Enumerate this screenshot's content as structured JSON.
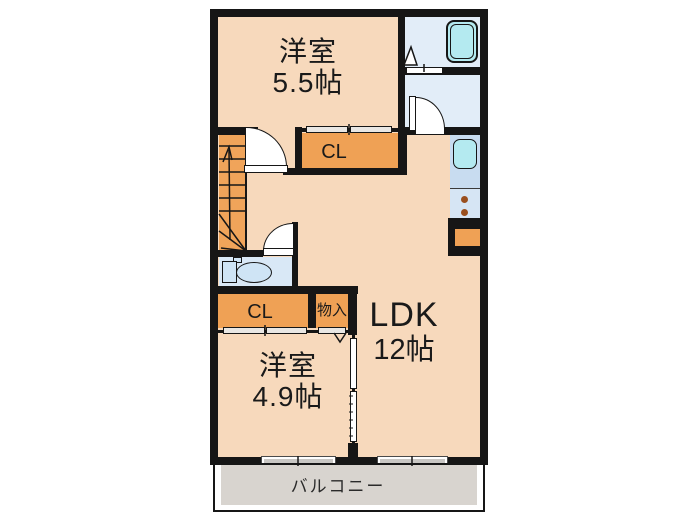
{
  "floor_plan": {
    "rooms": {
      "western_room_top": {
        "label": "洋室",
        "size": "5.5帖"
      },
      "ldk": {
        "label": "LDK",
        "size": "12帖"
      },
      "western_room_bottom": {
        "label": "洋室",
        "size": "4.9帖"
      },
      "closet_top": {
        "label": "CL"
      },
      "closet_bottom": {
        "label": "CL"
      },
      "storage": {
        "label": "物入"
      },
      "balcony": {
        "label": "バルコニー"
      }
    },
    "fixtures": [
      "staircase",
      "bathtub",
      "washroom-door",
      "toilet",
      "kitchen-sink",
      "stove-burners"
    ],
    "colors": {
      "wall": "#161616",
      "room_floor": "#f7d9bc",
      "closet_orange": "#efa155",
      "stairs_orange": "#f0a45a",
      "wet_area_floor": "#e2edf8",
      "kitchen_counter": "#c8dcf0",
      "water_fixture": "#b4eaf0",
      "balcony_deck": "#d8d4cf",
      "window_gray": "#c9c7c4"
    }
  }
}
